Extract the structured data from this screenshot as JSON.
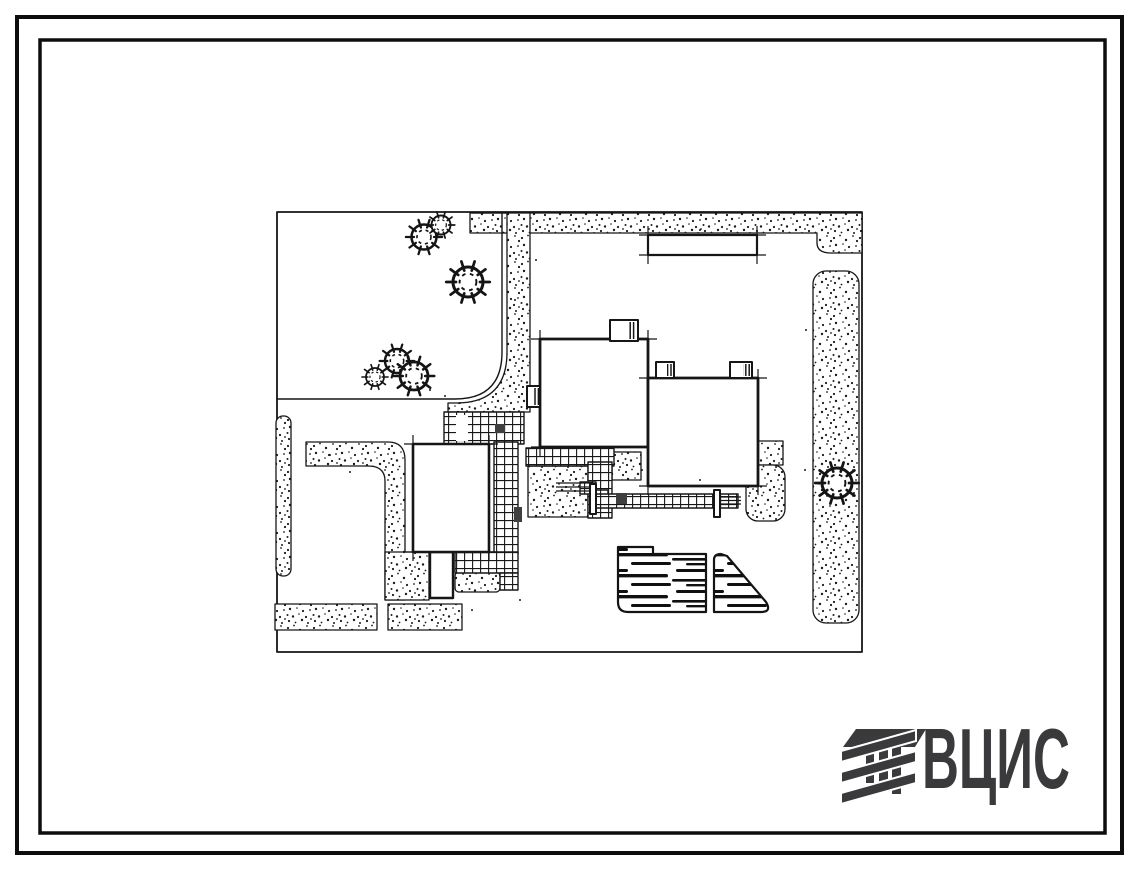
{
  "logo": {
    "text": "ВЦИС",
    "color": "#3a3a3c",
    "icon": "vcis-hatched-emblem-icon"
  },
  "colors": {
    "paper": "#ffffff",
    "ink": "#161616",
    "frame": "#0d0d0d",
    "accent_dark": "#3f3f3f"
  },
  "scene": {
    "kind": "architectural site plan drawing",
    "buildings": 3,
    "parking_areas": 2,
    "tree_clusters": 4
  }
}
